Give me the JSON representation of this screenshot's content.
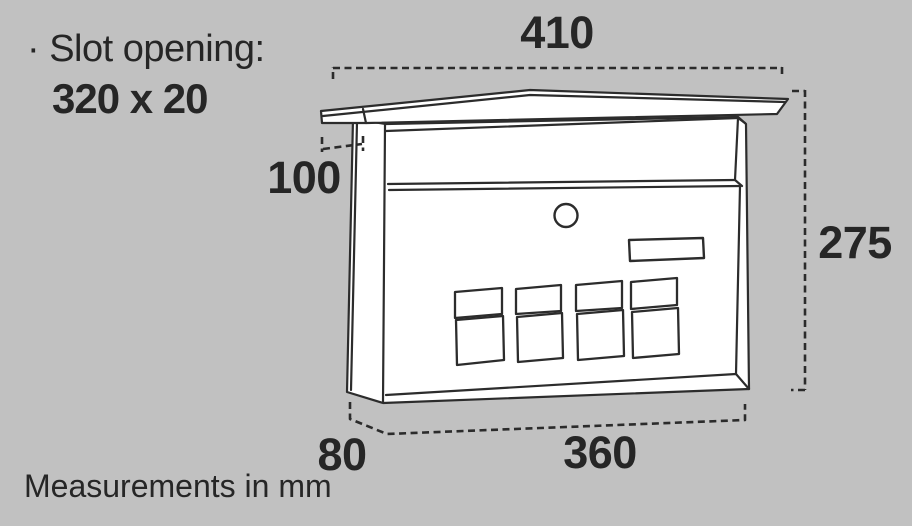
{
  "canvas": {
    "background": "#c1c1c1",
    "stroke_color": "#2c2c2c",
    "text_color": "#262626"
  },
  "annotations": {
    "slot_note_line1": "· Slot opening:",
    "slot_note_line2": "320 x 20",
    "footer": "Measurements in mm"
  },
  "dimensions_mm": {
    "top_width": "410",
    "lid_overhang": "100",
    "height": "275",
    "depth": "80",
    "front_width": "360"
  },
  "illustration": {
    "subject": "wall-mounted letterbox, three-quarter view line drawing",
    "features": [
      "peaked lid",
      "letter slot flap",
      "round cylinder lock",
      "name plate",
      "eight small window panels in two rows"
    ]
  }
}
